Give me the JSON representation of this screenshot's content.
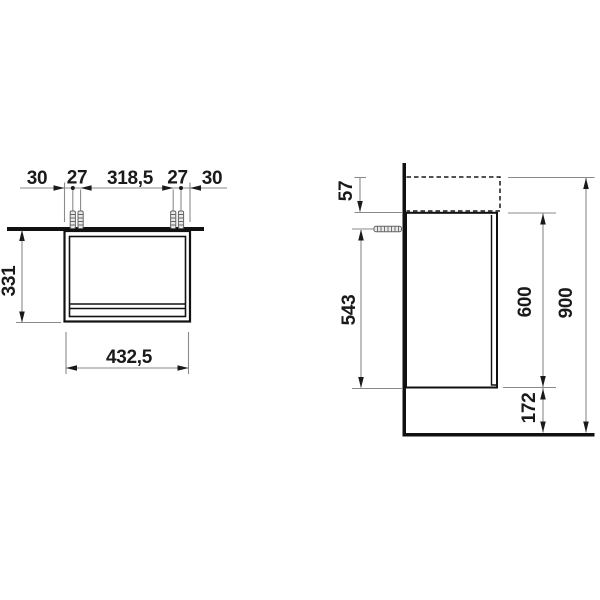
{
  "meta": {
    "type": "technical-dimension-drawing",
    "subject": "vanity-cabinet-installation-drawing",
    "unit": "mm",
    "background_color": "#ffffff",
    "outline_color": "#111111",
    "dimension_line_color": "#8a8a8a",
    "text_color": "#1a1a1a"
  },
  "front_view": {
    "label": "front view",
    "dims": {
      "edge_to_hole_left": "30",
      "hole_pair_left": "27",
      "hole_span_center": "318,5",
      "hole_pair_right": "27",
      "edge_to_hole_right": "30",
      "body_height": "331",
      "body_width": "432,5"
    }
  },
  "side_view": {
    "label": "side view",
    "dims": {
      "top_offset": "57",
      "fixing_to_bottom": "543",
      "cabinet_height": "600",
      "overall_height": "900",
      "floor_clearance": "172"
    }
  }
}
